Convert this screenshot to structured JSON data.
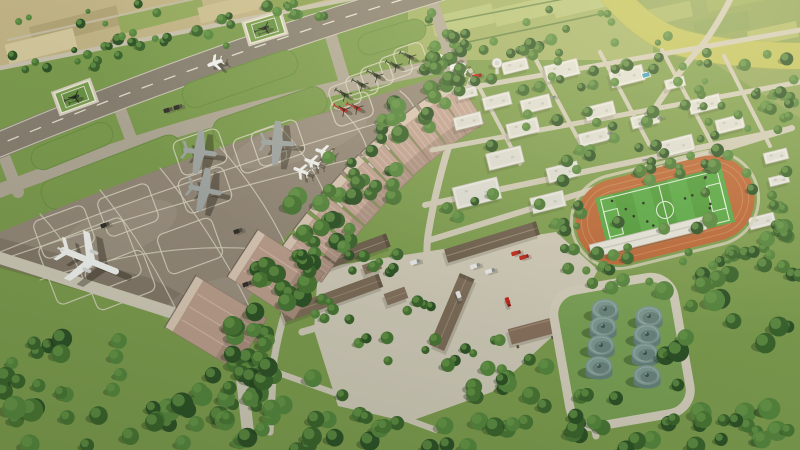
{
  "meta": {
    "alt": "Aerial 3D architectural rendering of an airport complex: diagonal runway with parallel taxiway and two grass helipads, large parking apron with a white airliner, gray turboprop aircraft, small white jets and green and red helicopters, a long row of pink-roofed hangars, tree belts, warehouse service area with fire trucks, white campus buildings with control tower and rooftop pool, a stadium with orange running track and soccer field, a fuel tank farm with eight cylindrical tanks, surrounded by farmland and a yellow-green canal crossed by a bridge road.",
    "width": 800,
    "height": 450
  },
  "palette": {
    "grass": "#7e9e50",
    "tree_palette": [
      "#2e5328",
      "#3b652e",
      "#4a7836",
      "#578840"
    ],
    "tree_light": "#6a9a4b",
    "tree_shadow": "#1e3317",
    "farm_nw_base": "#c3b587",
    "fields_base": "#a3b369",
    "plot_light": "#b7c47c",
    "farm_ne_base": "#93a75f",
    "river": "#c2c360",
    "river_edge": "#b0b150",
    "runway": "#8a8274",
    "runway_edge": "#d8d3c3",
    "centerline": "#e8e4d6",
    "taxiway": "#b3aa99",
    "concrete": "#d2ccbb",
    "apron": "#968a7b",
    "marking": "#ddd7c5",
    "hangar_face": "#dcc9b7",
    "hangar_roof": "#c5a698",
    "hangar_roof_light": "#d8bcab",
    "hangar_edge": "#8d7a6c",
    "big_hangar_roof": "#bea08f",
    "white_bldg": "#ecebe5",
    "white_bldg_inner": "#e1e0d9",
    "white_bldg_edge": "#bdbcb2",
    "roof_unit": "#c9c9c1",
    "warehouse_a": "#6f604f",
    "warehouse_b": "#7e6d5a",
    "shed": "#85725f",
    "canopy": "#8a7260",
    "canopy_edge": "#a08673",
    "track": "#bf6838",
    "track_lane": "#d08a5c",
    "track_rim": "#d8d2bf",
    "field": "#4f9d3b",
    "field_stripe": "#58aa45",
    "field_line": "#e9f4e6",
    "grandstand": "#e9e7e0",
    "tank_top": "#7f9b95",
    "tank_side": "#66837d",
    "tank_rim": "#9cb3ad",
    "tank_cap": "#3e5a55",
    "lawn": "#7ba256",
    "loop_road": "#d6d0bf",
    "plane_white": "#f4f5f3",
    "plane_gray": "#a4a9a7",
    "heli_green": "#39462f",
    "heli_red": "#b52a20",
    "tug": "#34312b",
    "truck_white": "#eceded",
    "fire_red": "#c2251c",
    "car": "#8f949a",
    "pool": "#3e9ec4",
    "shadow": "rgba(35,32,22,0.38)"
  },
  "terrain": {
    "farm_nw": {
      "poly": "0,0 352,0 0,66",
      "patches": [
        [
          30,
          16,
          90,
          20,
          "#b3a678"
        ],
        [
          118,
          6,
          86,
          18,
          "#95aa5e"
        ],
        [
          198,
          -2,
          80,
          16,
          "#cdc192"
        ],
        [
          266,
          -9,
          76,
          14,
          "#8da355"
        ],
        [
          6,
          36,
          70,
          20,
          "#d5c99e"
        ]
      ],
      "rot": -14,
      "boundary_road": "M0,68 L354,-2",
      "inner_road": "M8,40 L262,-16"
    },
    "fields_top": {
      "rect": [
        408,
        0,
        245,
        60
      ],
      "plots": [
        [
          432,
          10,
          62,
          20
        ],
        [
          494,
          2,
          62,
          18
        ],
        [
          553,
          -5,
          58,
          17
        ]
      ],
      "rot": -13,
      "hedges": [
        "M424,26 L600,-8",
        "M440,48 L628,8"
      ]
    },
    "farm_ne": {
      "poly": "555,0 800,0 800,118 690,48 608,0",
      "patches": [
        [
          640,
          6,
          52,
          16,
          "#a8b86a"
        ],
        [
          694,
          16,
          56,
          18,
          "#8ba45c"
        ],
        [
          748,
          26,
          50,
          16,
          "#b4bd6e"
        ],
        [
          706,
          -8,
          60,
          14,
          "#9db05f"
        ],
        [
          764,
          48,
          44,
          14,
          "#90a85e"
        ]
      ],
      "rot": -12
    },
    "river": {
      "path": "M608,-12 Q638,26 672,40 Q716,55 800,56",
      "width": 26
    },
    "bridge_road": {
      "path": "M645,124 Q676,74 700,48 Q716,28 734,-8",
      "width": 6
    }
  },
  "airfield": {
    "runway": {
      "path": "M-14,150 Q200,60 440,-12",
      "width": 27,
      "edges": [
        "M-14,137 Q196,47 432,-23",
        "M-14,163 Q204,73 448,-1"
      ],
      "dash": "11,13"
    },
    "taxiway": {
      "path": "M-14,196 Q205,110 460,62",
      "width": 14
    },
    "connectors": [
      [
        0,
        146,
        18,
        192
      ],
      [
        118,
        104,
        136,
        152
      ],
      [
        328,
        26,
        346,
        86
      ],
      [
        430,
        -4,
        452,
        60
      ]
    ],
    "islands_north": [
      [
        72,
        146,
        86,
        24,
        -22
      ],
      [
        240,
        79,
        120,
        26,
        -19
      ],
      [
        392,
        37,
        70,
        22,
        -17
      ]
    ],
    "islands_south": [
      [
        112,
        172,
        148,
        30,
        -21
      ],
      [
        270,
        116,
        118,
        28,
        -19
      ]
    ],
    "apron": {
      "outline": "M0,232 Q205,146 455,72 L462,86 Q348,158 270,256 Q250,290 242,324 L216,328 L0,266 Z",
      "dark_overlay": "M0,238 L150,278 L242,324 L216,328 L0,268 Z",
      "col_lines": [
        "M40,214 Q74,250 88,291",
        "M100,190 Q150,252 180,318",
        "M160,168 Q215,236 250,308",
        "M220,147 Q264,197 288,250",
        "M280,127 Q313,162 327,200",
        "M340,109 Q364,130 368,154",
        "M400,91 Q412,100 416,112"
      ],
      "row_lines": [
        "M0,252 Q200,172 418,112",
        "M0,260 Q190,196 366,156",
        "M40,280 Q170,236 286,252"
      ],
      "empty_spots": [
        [
          64,
          232,
          54,
          40,
          -20
        ],
        [
          128,
          210,
          54,
          40,
          -20
        ],
        [
          190,
          246,
          58,
          42,
          -20
        ],
        [
          120,
          280,
          62,
          44,
          -21
        ],
        [
          260,
          150,
          48,
          36,
          -19
        ]
      ]
    },
    "helipads": [
      [
        75,
        97,
        -20
      ],
      [
        265,
        28,
        -17
      ]
    ],
    "hangar_bays": [
      [
        452,
        92,
        57
      ],
      [
        432,
        105,
        54.5
      ],
      [
        412,
        120,
        52
      ],
      [
        393,
        135,
        49.5
      ],
      [
        375,
        152,
        47
      ],
      [
        357,
        169,
        44.5
      ],
      [
        340,
        188,
        42
      ],
      [
        323,
        207,
        39.5
      ],
      [
        307,
        227,
        37.5
      ],
      [
        292,
        248,
        35.5
      ]
    ],
    "hangars_large": [
      [
        250,
        258,
        33,
        70,
        56
      ],
      [
        188,
        306,
        31,
        74,
        60
      ]
    ]
  },
  "aircraft": {
    "airliners": [
      [
        90,
        261,
        22
      ]
    ],
    "turboprops": [
      [
        200,
        152,
        8
      ],
      [
        278,
        143,
        4
      ],
      [
        205,
        190,
        12
      ]
    ],
    "jets": [
      [
        323,
        152,
        198
      ],
      [
        312,
        162,
        200
      ],
      [
        301,
        171,
        202
      ],
      [
        446,
        58,
        200
      ],
      [
        452,
        64,
        200
      ],
      [
        459,
        70,
        200
      ],
      [
        215,
        63,
        160
      ]
    ],
    "helis_green": [
      [
        410,
        57,
        205
      ],
      [
        396,
        66,
        205
      ],
      [
        377,
        76,
        208
      ],
      [
        362,
        85,
        208
      ],
      [
        345,
        95,
        210
      ],
      [
        75,
        97,
        160
      ],
      [
        265,
        28,
        160
      ]
    ],
    "helis_red": [
      [
        344,
        110,
        205
      ],
      [
        357,
        108,
        205
      ]
    ],
    "red_spot": [
      352,
      109,
      40,
      26,
      -19
    ]
  },
  "service": {
    "yard": "M318,268 L556,232 L598,270 L568,322 L492,392 L408,422 L338,406 L314,330 Z",
    "roads": [
      {
        "d": "M457,84 Q360,160 305,260 Q282,310 274,360 L270,432",
        "w": 7
      },
      {
        "d": "M0,258 L214,326 Q236,334 240,360 L248,432",
        "w": 12
      },
      {
        "d": "M302,332 L558,258",
        "w": 7
      },
      {
        "d": "M434,292 Q446,330 470,352",
        "w": 6
      },
      {
        "d": "M276,372 Q360,402 436,430",
        "w": 6
      },
      {
        "d": "M472,80 Q440,160 428,235 Q424,266 434,292",
        "w": 7
      },
      {
        "d": "M430,240 L792,128",
        "w": 6
      },
      {
        "d": "M560,300 Q585,382 596,436",
        "w": 7
      }
    ],
    "warehouses": [
      [
        347,
        255,
        88,
        14,
        -20,
        "a"
      ],
      [
        332,
        298,
        104,
        14,
        -20,
        "b"
      ],
      [
        492,
        242,
        96,
        14,
        -17,
        "a"
      ],
      [
        452,
        312,
        78,
        16,
        -67,
        "b"
      ]
    ],
    "sheds": [
      [
        396,
        296,
        22,
        12,
        -20
      ],
      [
        372,
        267,
        18,
        10,
        -20
      ],
      [
        236,
        345,
        16,
        9,
        -25
      ],
      [
        262,
        338,
        14,
        8,
        -25
      ]
    ],
    "canopy": [
      532,
      331,
      46,
      16,
      -15
    ]
  },
  "campus": {
    "rot": -14,
    "streets": [
      {
        "d": "M445,92 L800,30",
        "w": 5
      },
      {
        "d": "M432,150 L800,82",
        "w": 5
      },
      {
        "d": "M425,205 L785,130",
        "w": 6
      }
    ],
    "cross_streets": [
      {
        "d": "M470,70 L520,164",
        "w": 4
      },
      {
        "d": "M535,58 L585,152",
        "w": 4
      },
      {
        "d": "M600,52 L650,146",
        "w": 4
      },
      {
        "d": "M662,50 L712,144",
        "w": 4
      },
      {
        "d": "M724,56 L770,146",
        "w": 4
      }
    ],
    "buildings": [
      [
        515,
        66,
        26,
        12
      ],
      [
        562,
        70,
        34,
        16
      ],
      [
        627,
        76,
        34,
        16
      ],
      [
        675,
        83,
        20,
        10
      ],
      [
        705,
        104,
        32,
        14
      ],
      [
        730,
        124,
        28,
        14
      ],
      [
        467,
        93,
        20,
        10
      ],
      [
        497,
        101,
        28,
        13
      ],
      [
        536,
        104,
        30,
        14
      ],
      [
        600,
        111,
        30,
        14
      ],
      [
        645,
        120,
        28,
        12
      ],
      [
        468,
        121,
        28,
        13
      ],
      [
        523,
        128,
        32,
        15
      ],
      [
        594,
        137,
        30,
        13
      ],
      [
        676,
        146,
        36,
        16
      ],
      [
        710,
        166,
        32,
        14
      ],
      [
        505,
        158,
        36,
        17
      ],
      [
        563,
        172,
        32,
        15
      ],
      [
        477,
        193,
        46,
        22
      ],
      [
        548,
        202,
        34,
        16
      ],
      [
        762,
        221,
        26,
        12
      ],
      [
        776,
        156,
        24,
        11
      ],
      [
        779,
        180,
        20,
        9
      ]
    ],
    "tower": [
      497,
      63
    ],
    "pool": [
      646,
      75,
      8,
      5
    ]
  },
  "stadium": {
    "cx": 665,
    "cy": 210,
    "rot": -14,
    "track_w": 182,
    "track_h": 86,
    "track_rx": 43,
    "lane_insets": [
      6,
      12
    ],
    "field_w": 130,
    "field_h": 57,
    "stripes": 7,
    "circle_r": 8.5,
    "box_w": 14,
    "box_h": 26,
    "grandstand": [
      648,
      237,
      118,
      13,
      -14
    ],
    "players": 13,
    "players_seed": 9
  },
  "tank_farm": {
    "loop": [
      622,
      352,
      122,
      138,
      -10,
      24
    ],
    "road_w": 9,
    "tanks": [
      [
        605,
        309
      ],
      [
        649,
        316
      ],
      [
        603,
        326
      ],
      [
        647,
        334
      ],
      [
        601,
        345
      ],
      [
        645,
        353
      ],
      [
        599,
        366
      ],
      [
        647,
        375
      ]
    ],
    "rx": 13.5,
    "ry": 10
  },
  "vehicles": {
    "tugs": [
      [
        238,
        231,
        -20
      ],
      [
        247,
        284,
        -20
      ],
      [
        168,
        110,
        -18
      ],
      [
        178,
        107,
        -18
      ],
      [
        105,
        225,
        -20
      ]
    ],
    "trucks_white": [
      [
        459,
        296,
        70
      ],
      [
        475,
        266,
        -17
      ],
      [
        490,
        271,
        -17
      ],
      [
        578,
        417,
        85
      ],
      [
        415,
        262,
        -17
      ]
    ],
    "fire_trucks": [
      [
        508,
        302,
        70
      ],
      [
        516,
        253,
        -17
      ],
      [
        524,
        257,
        -17
      ],
      [
        477,
        76,
        -14
      ]
    ],
    "cars": [
      [
        610,
        133,
        -14
      ],
      [
        660,
        118,
        -14
      ],
      [
        553,
        97,
        -14
      ],
      [
        700,
        108,
        -14
      ],
      [
        645,
        160,
        -14
      ]
    ]
  },
  "trees": {
    "clusters": [
      [
        0,
        46,
        122,
        26,
        12,
        3,
        6,
        11
      ],
      [
        112,
        24,
        122,
        26,
        12,
        3,
        6,
        12
      ],
      [
        220,
        2,
        122,
        26,
        11,
        3,
        6,
        13
      ],
      [
        2,
        2,
        180,
        40,
        8,
        2.5,
        5,
        14
      ],
      [
        428,
        56,
        64,
        44,
        10,
        5,
        8,
        15
      ],
      [
        376,
        96,
        74,
        50,
        13,
        5,
        9,
        16
      ],
      [
        326,
        146,
        74,
        54,
        15,
        5,
        9,
        17
      ],
      [
        286,
        196,
        70,
        58,
        15,
        6,
        10,
        18
      ],
      [
        252,
        250,
        64,
        62,
        15,
        6,
        10,
        19
      ],
      [
        226,
        304,
        60,
        60,
        13,
        6,
        10,
        20
      ],
      [
        210,
        354,
        60,
        64,
        13,
        6,
        10,
        21
      ],
      [
        0,
        390,
        282,
        60,
        24,
        7,
        12,
        22
      ],
      [
        0,
        336,
        142,
        58,
        14,
        6,
        10,
        23
      ],
      [
        148,
        414,
        254,
        36,
        16,
        6,
        10,
        24
      ],
      [
        376,
        414,
        214,
        36,
        13,
        6,
        10,
        25
      ],
      [
        226,
        366,
        122,
        54,
        10,
        6,
        10,
        26
      ],
      [
        283,
        251,
        140,
        22,
        11,
        4,
        7,
        27
      ],
      [
        296,
        298,
        142,
        22,
        11,
        4,
        7,
        28
      ],
      [
        348,
        336,
        152,
        28,
        11,
        4,
        7,
        29
      ],
      [
        428,
        354,
        134,
        46,
        10,
        5,
        9,
        30
      ],
      [
        443,
        46,
        352,
        192,
        62,
        3.5,
        6.5,
        31
      ],
      [
        428,
        32,
        132,
        26,
        10,
        4,
        6,
        32
      ],
      [
        552,
        60,
        132,
        28,
        10,
        4,
        6,
        33
      ],
      [
        676,
        94,
        122,
        32,
        10,
        4,
        6,
        34
      ],
      [
        563,
        146,
        207,
        28,
        15,
        4,
        7,
        35
      ],
      [
        558,
        230,
        86,
        42,
        9,
        4,
        7,
        36
      ],
      [
        693,
        194,
        107,
        86,
        16,
        5,
        9,
        37
      ],
      [
        586,
        246,
        147,
        42,
        12,
        4,
        7,
        38
      ],
      [
        658,
        266,
        142,
        166,
        26,
        6,
        11,
        39
      ],
      [
        766,
        56,
        34,
        204,
        12,
        4,
        7,
        40
      ],
      [
        426,
        0,
        192,
        54,
        14,
        3,
        5,
        41
      ],
      [
        410,
        32,
        54,
        60,
        9,
        4,
        7,
        42
      ],
      [
        476,
        376,
        192,
        66,
        14,
        6,
        10,
        43
      ],
      [
        643,
        36,
        147,
        60,
        8,
        3,
        5,
        44
      ],
      [
        600,
        416,
        202,
        34,
        10,
        6,
        10,
        45
      ]
    ]
  }
}
